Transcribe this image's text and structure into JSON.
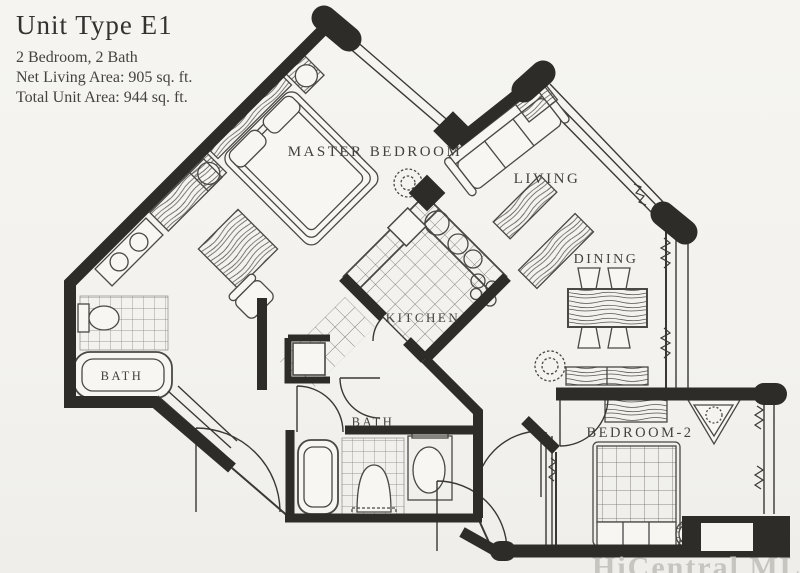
{
  "page": {
    "background": "#f4f3ef",
    "ink": "#2e2c29",
    "watermark_color": "#c7c5bf"
  },
  "title_block": {
    "title": "Unit Type E1",
    "subtitle": "2 Bedroom, 2 Bath",
    "net_area": "Net Living Area: 905 sq. ft.",
    "total_area": "Total Unit Area: 944 sq. ft."
  },
  "unit": {
    "type": "E1",
    "bedrooms": 2,
    "baths": 2,
    "net_living_area_sqft": 905,
    "total_unit_area_sqft": 944
  },
  "room_labels": {
    "master_bedroom": "MASTER BEDROOM",
    "living": "LIVING",
    "dining": "DINING",
    "kitchen": "KITCHEN",
    "bath_1": "BATH",
    "bath_2": "BATH",
    "bedroom_2": "BEDROOM-2"
  },
  "watermark": "HiCentral MLS"
}
